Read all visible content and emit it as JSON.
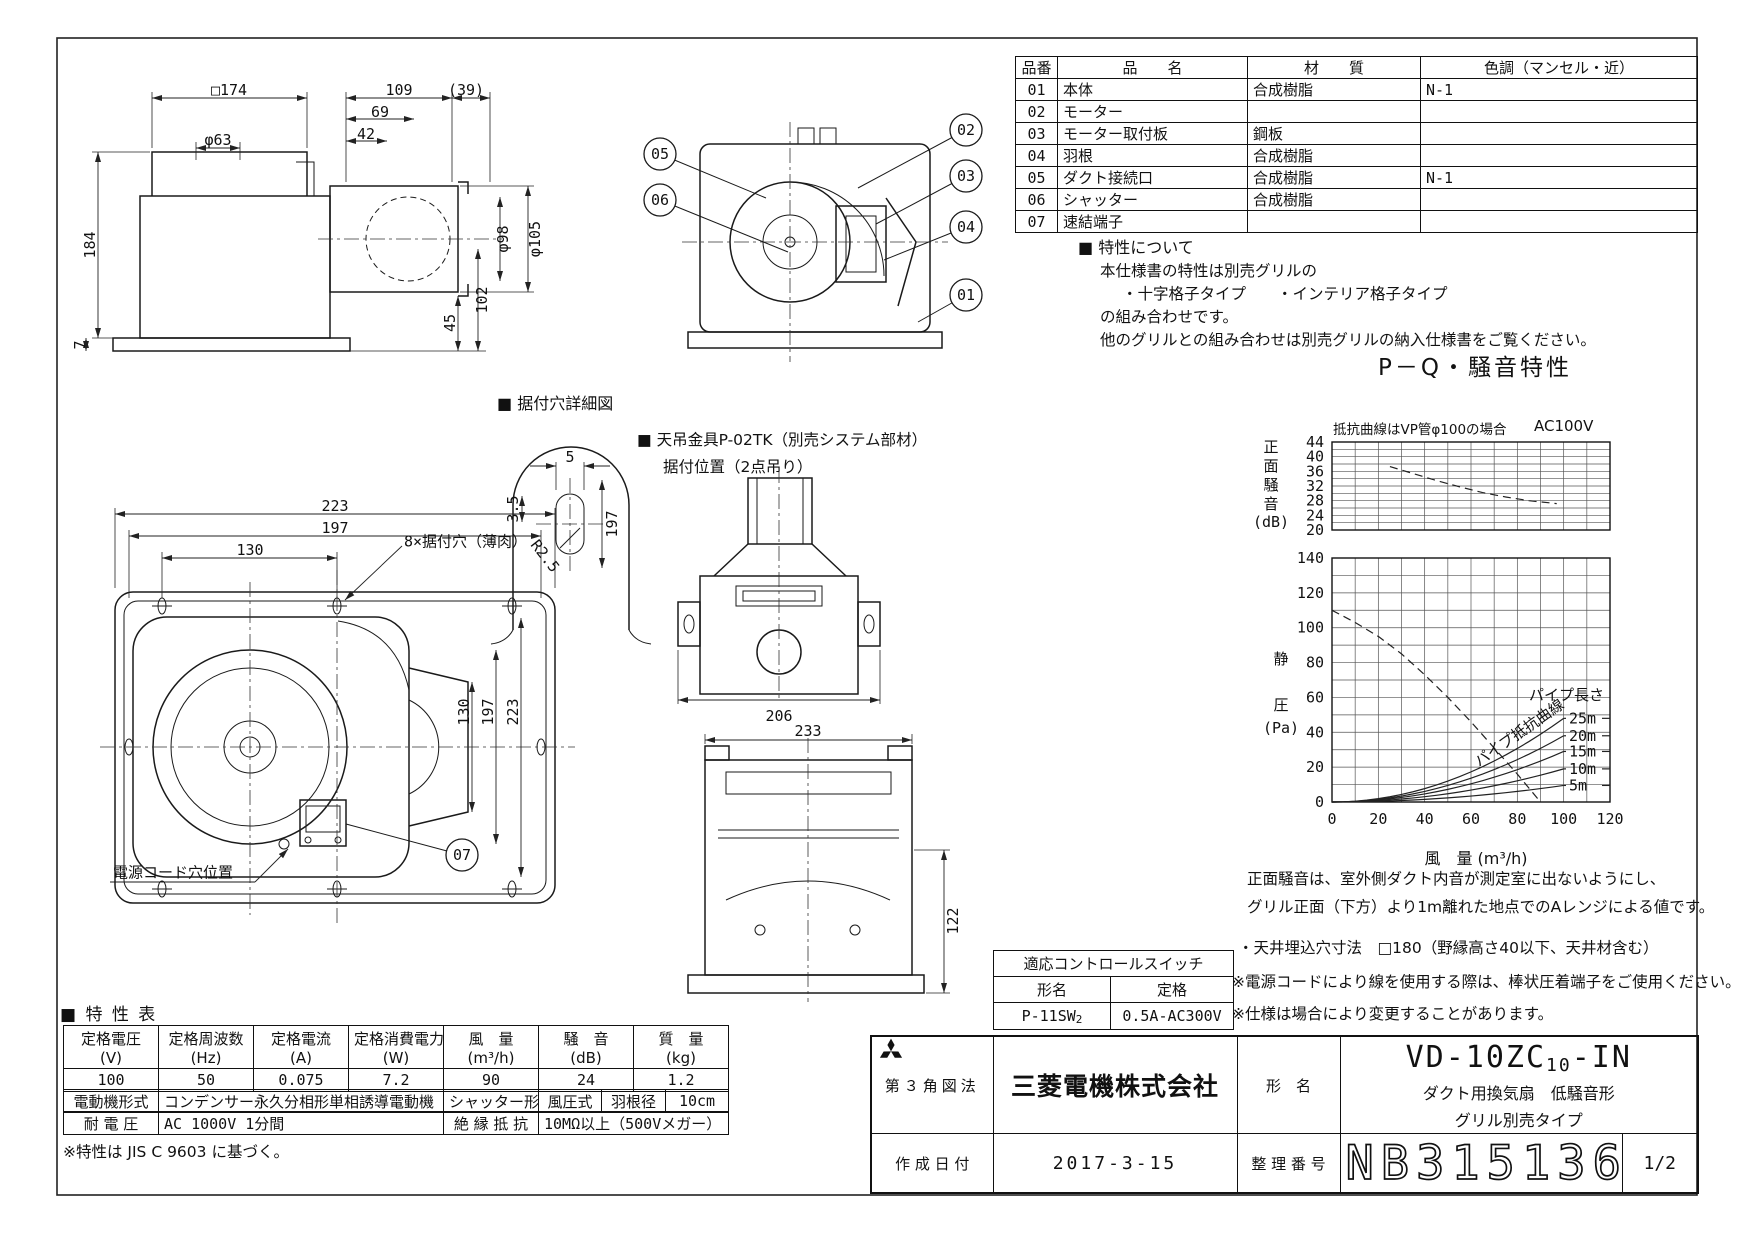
{
  "parts_table": {
    "headers": {
      "no": "品番",
      "name": "品　　名",
      "material": "材　　質",
      "color": "色調（マンセル・近）"
    },
    "rows": [
      {
        "no": "01",
        "name": "本体",
        "material": "合成樹脂",
        "color": "N-1"
      },
      {
        "no": "02",
        "name": "モーター",
        "material": "",
        "color": ""
      },
      {
        "no": "03",
        "name": "モーター取付板",
        "material": "鋼板",
        "color": ""
      },
      {
        "no": "04",
        "name": "羽根",
        "material": "合成樹脂",
        "color": ""
      },
      {
        "no": "05",
        "name": "ダクト接続口",
        "material": "合成樹脂",
        "color": "N-1"
      },
      {
        "no": "06",
        "name": "シャッター",
        "material": "合成樹脂",
        "color": ""
      },
      {
        "no": "07",
        "name": "速結端子",
        "material": "",
        "color": ""
      }
    ]
  },
  "features_note": {
    "title": "■ 特性について",
    "lines": [
      "本仕様書の特性は別売グリルの",
      "・十字格子タイプ　　・インテリア格子タイプ",
      "の組み合わせです。",
      "他のグリルとの組み合わせは別売グリルの納入仕様書をご覧ください。"
    ]
  },
  "chart_data": [
    {
      "type": "line",
      "title": "P－Q・騒音特性",
      "subtitle_left": "抵抗曲線はVP管φ100の場合",
      "subtitle_right": "AC100V",
      "ylabel": "正面騒音",
      "ylabel_unit": "(dB)",
      "ylim": [
        20,
        44
      ],
      "ytick_step": 4,
      "grid_minor_y": 2,
      "xlim": [
        0,
        120
      ],
      "grid_x": 10,
      "legend": "none",
      "series": [
        {
          "name": "正面騒音",
          "style": "dashed",
          "points": [
            [
              25,
              37.3
            ],
            [
              35,
              35.4
            ],
            [
              45,
              33.5
            ],
            [
              55,
              31.8
            ],
            [
              65,
              30.2
            ],
            [
              75,
              29.0
            ],
            [
              85,
              28.0
            ],
            [
              97,
              27.2
            ]
          ]
        }
      ]
    },
    {
      "type": "line",
      "ylabel": "静圧",
      "ylabel_unit": "(Pa)",
      "ylim": [
        0,
        140
      ],
      "ytick_step": 20,
      "grid_minor_y": 10,
      "xlim": [
        0,
        120
      ],
      "grid_x": 10,
      "xticks": [
        0,
        20,
        40,
        60,
        80,
        100,
        120
      ],
      "xlabel": "風　量 (m³/h)",
      "series": [
        {
          "name": "P-Q曲線",
          "style": "dashed",
          "points": [
            [
              0,
              110
            ],
            [
              10,
              103
            ],
            [
              20,
              95
            ],
            [
              30,
              85
            ],
            [
              40,
              73
            ],
            [
              50,
              60
            ],
            [
              60,
              46
            ],
            [
              70,
              31
            ],
            [
              80,
              16
            ],
            [
              90,
              0
            ]
          ]
        }
      ],
      "pipe_curves": {
        "label_title": "パイプ長さ",
        "label_curve": "パイプ抵抗曲線",
        "end_flow": 100,
        "lengths": [
          {
            "name": "25m",
            "p_at_end": 48
          },
          {
            "name": "20m",
            "p_at_end": 38
          },
          {
            "name": "15m",
            "p_at_end": 29
          },
          {
            "name": "10m",
            "p_at_end": 19
          },
          {
            "name": "5m",
            "p_at_end": 9.5
          }
        ]
      }
    }
  ],
  "chart_notes": [
    "正面騒音は、室外側ダクト内音が測定室に出ないようにし、",
    "グリル正面（下方）より1m離れた地点でのAレンジによる値です。"
  ],
  "control_switch": {
    "title": "適応コントロールスイッチ",
    "col1": "形名",
    "col2": "定格",
    "model_prefix": "P-11SW",
    "model_sub": "2",
    "rating": "0.5A-AC300V"
  },
  "remarks": [
    "・天井埋込穴寸法　□180（野縁高さ40以下、天井材含む）",
    "※電源コードにより線を使用する際は、棒状圧着端子をご使用ください。",
    "※仕様は場合により変更することがあります。"
  ],
  "spec_table": {
    "heading": "■ 特 性 表",
    "cols": [
      {
        "name": "定格電圧",
        "unit": "(V)",
        "value": "100"
      },
      {
        "name": "定格周波数",
        "unit": "(Hz)",
        "value": "50"
      },
      {
        "name": "定格電流",
        "unit": "(A)",
        "value": "0.075"
      },
      {
        "name": "定格消費電力",
        "unit": "(W)",
        "value": "7.2"
      },
      {
        "name": "風　量",
        "unit": "(m³/h)",
        "value": "90"
      },
      {
        "name": "騒　音",
        "unit": "(dB)",
        "value": "24"
      },
      {
        "name": "質　量",
        "unit": "(kg)",
        "value": "1.2"
      }
    ],
    "row3": {
      "c1": "電動機形式",
      "c2": "コンデンサー永久分相形単相誘導電動機　2極",
      "c3": "シャッター形式",
      "c4": "風圧式",
      "c5": "羽根径",
      "c6": "10cm"
    },
    "row4": {
      "c1": "耐 電 圧",
      "c2": "AC 1000V 1分間",
      "c3": "絶 縁 抵 抗",
      "c4": "10MΩ以上（500Vメガー）"
    },
    "footnote": "※特性は JIS C 9603 に基づく。"
  },
  "title_block": {
    "projection": "第３角図法",
    "company": "三菱電機株式会社",
    "model_label": "形　名",
    "model_prefix": "VD-10ZC",
    "model_sub": "10",
    "model_suffix": "-IN",
    "model_desc1": "ダクト用換気扇　低騒音形",
    "model_desc2": "グリル別売タイプ",
    "date_label": "作 成 日 付",
    "date": "2017-3-15",
    "number_label": "整 理 番 号",
    "number": "NB315136A",
    "page": "1/2"
  },
  "drawing_labels": {
    "detail_heading": "■ 据付穴詳細図",
    "bracket_line1": "■ 天吊金具P-02TK（別売システム部材）",
    "bracket_line2": "据付位置（2点吊り）"
  },
  "annotations": [
    {
      "t": "□174",
      "x": 229,
      "y": 90
    },
    {
      "t": "φ63",
      "x": 218,
      "y": 140
    },
    {
      "t": "109",
      "x": 399,
      "y": 90
    },
    {
      "t": "(39)",
      "x": 466,
      "y": 90
    },
    {
      "t": "69",
      "x": 380,
      "y": 112
    },
    {
      "t": "42",
      "x": 366,
      "y": 134
    },
    {
      "t": "184",
      "x": 90,
      "y": 245,
      "r": -90
    },
    {
      "t": "φ98",
      "x": 503,
      "y": 239,
      "r": -90
    },
    {
      "t": "φ105",
      "x": 535,
      "y": 239,
      "r": -90
    },
    {
      "t": "102",
      "x": 482,
      "y": 300,
      "r": -90
    },
    {
      "t": "45",
      "x": 450,
      "y": 323,
      "r": -90
    },
    {
      "t": "7",
      "x": 80,
      "y": 345,
      "r": -90
    },
    {
      "t": "5",
      "x": 570,
      "y": 457
    },
    {
      "t": "3.5",
      "x": 513,
      "y": 509,
      "r": -90
    },
    {
      "t": "R2.5",
      "x": 545,
      "y": 556,
      "r": 52
    },
    {
      "t": "197",
      "x": 612,
      "y": 524,
      "r": -90
    },
    {
      "t": "206",
      "x": 779,
      "y": 716
    },
    {
      "t": "233",
      "x": 808,
      "y": 731
    },
    {
      "t": "122",
      "x": 953,
      "y": 921,
      "r": -90
    },
    {
      "t": "223",
      "x": 335,
      "y": 506
    },
    {
      "t": "197",
      "x": 335,
      "y": 528
    },
    {
      "t": "130",
      "x": 250,
      "y": 550
    },
    {
      "t": "130",
      "x": 464,
      "y": 712,
      "r": -90
    },
    {
      "t": "197",
      "x": 488,
      "y": 712,
      "r": -90
    },
    {
      "t": "223",
      "x": 513,
      "y": 712,
      "r": -90
    },
    {
      "t": "8×据付穴（薄肉）",
      "x": 404,
      "y": 541,
      "a": "start"
    },
    {
      "t": "電源コード穴位置",
      "x": 113,
      "y": 872,
      "a": "start"
    }
  ],
  "balloons": [
    {
      "n": "05",
      "x": 660,
      "y": 154,
      "tx": 766,
      "ty": 198
    },
    {
      "n": "06",
      "x": 660,
      "y": 200,
      "tx": 788,
      "ty": 252
    },
    {
      "n": "02",
      "x": 966,
      "y": 130,
      "tx": 858,
      "ty": 188
    },
    {
      "n": "03",
      "x": 966,
      "y": 176,
      "tx": 876,
      "ty": 224
    },
    {
      "n": "04",
      "x": 966,
      "y": 227,
      "tx": 884,
      "ty": 260
    },
    {
      "n": "01",
      "x": 966,
      "y": 295,
      "tx": 918,
      "ty": 322
    },
    {
      "n": "07",
      "x": 462,
      "y": 855,
      "tx": 346,
      "ty": 824
    }
  ]
}
